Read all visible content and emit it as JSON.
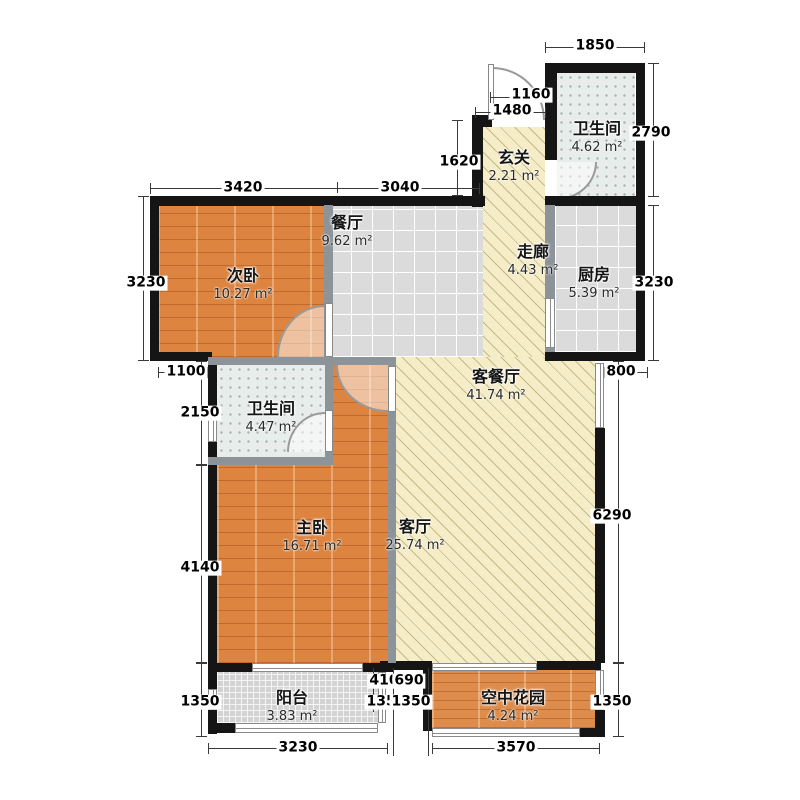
{
  "plan": {
    "rooms": [
      {
        "key": "bath_top",
        "name": "卫生间",
        "area": "4.62 m²"
      },
      {
        "key": "entry",
        "name": "玄关",
        "area": "2.21 m²"
      },
      {
        "key": "dining",
        "name": "餐厅",
        "area": "9.62 m²"
      },
      {
        "key": "bedroom2",
        "name": "次卧",
        "area": "10.27 m²"
      },
      {
        "key": "corridor",
        "name": "走廊",
        "area": "4.43 m²"
      },
      {
        "key": "kitchen",
        "name": "厨房",
        "area": "5.39 m²"
      },
      {
        "key": "living_dining",
        "name": "客餐厅",
        "area": "41.74 m²"
      },
      {
        "key": "bath_mid",
        "name": "卫生间",
        "area": "4.47 m²"
      },
      {
        "key": "master",
        "name": "主卧",
        "area": "16.71 m²"
      },
      {
        "key": "living",
        "name": "客厅",
        "area": "25.74 m²"
      },
      {
        "key": "balcony",
        "name": "阳台",
        "area": "3.83 m²"
      },
      {
        "key": "garden",
        "name": "空中花园",
        "area": "4.24 m²"
      }
    ],
    "dims": {
      "top_1850": "1850",
      "right_2790": "2790",
      "top_1160": "1160",
      "top_1480": "1480",
      "left_1620": "1620",
      "top_3420": "3420",
      "top_3040": "3040",
      "left_3230": "3230",
      "right_3230": "3230",
      "right_800": "800",
      "left_1100": "1100",
      "left_2150": "2150",
      "left_4140": "4140",
      "left_1350": "1350",
      "right_6290": "6290",
      "mid_410": "410",
      "mid_690": "690",
      "mid_1350a": "1350",
      "mid_1350b": "1350",
      "bottom_3230": "3230",
      "bottom_3570": "3570",
      "right_1350": "1350"
    },
    "colors": {
      "wood": "#DC8440",
      "tile": "#DBDBDB",
      "bath_tile": "#E8EDEC",
      "hatch": "#F5EDC8",
      "balcony_tile": "#D3D3D3",
      "wall": "#151515",
      "partition": "#8D9499"
    }
  }
}
